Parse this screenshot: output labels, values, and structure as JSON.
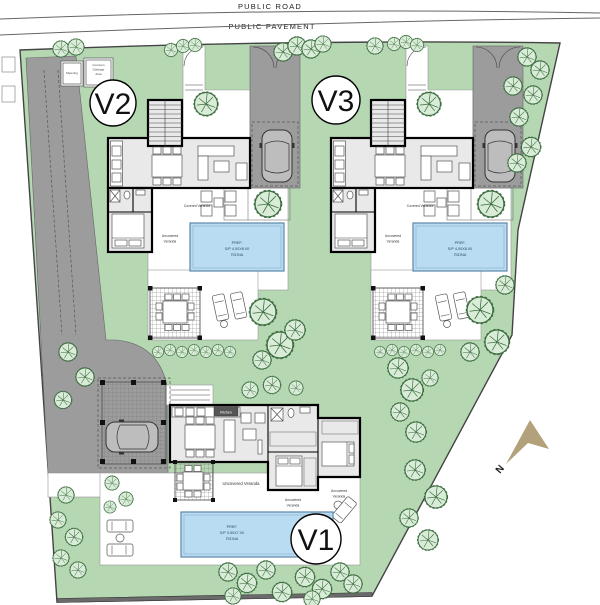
{
  "road": {
    "public_road": "PUBLIC ROAD",
    "public_pavement": "PUBLIC PAVEMENT"
  },
  "compass": {
    "label": "N",
    "color": "#b2a17b"
  },
  "villa_common": {
    "covered_veranda": "Covered Veranda",
    "uncovered_line1": "Uncovered",
    "uncovered_line2": "Veranda",
    "pool_line1": "PREF.",
    "pool_line2": "S/P 4.00X8.00",
    "pool_line3": "ΠΙΣΙΝΑ"
  },
  "villas": {
    "v1": {
      "label": "V1",
      "kitchen": "Kitchen",
      "pool_line1": "PREF.",
      "pool_line2": "S/P 3.50X7.00",
      "pool_line3": "ΠΙΣΙΝΑ",
      "uncovered_center": "Uncovered Veranda",
      "uncovered_1_line1": "Uncovered",
      "uncovered_1_line2": "Veranda",
      "uncovered_2_line1": "Uncovered",
      "uncovered_2_line2": "Veranda"
    },
    "v2": {
      "label": "V2"
    },
    "v3": {
      "label": "V3"
    }
  },
  "utilities": {
    "metering": "Metering",
    "garbage_1": "Common",
    "garbage_2": "Garbage",
    "garbage_3": "Area"
  },
  "colors": {
    "landscape_green": "#b5d7b2",
    "pool_blue": "#badcf2",
    "pool_border": "#5d87a8",
    "driveway_gray": "#9c9c9c",
    "building_gray": "#e9e9e9",
    "wall_black": "#000000",
    "tree_fill": "#d9ecd7",
    "tree_stroke": "#3a6b3e",
    "compass_tan": "#b2a17b"
  },
  "trees": [
    [
      61,
      49,
      0.8
    ],
    [
      76,
      47,
      0.8
    ],
    [
      171,
      50,
      0.65
    ],
    [
      183,
      46,
      0.65
    ],
    [
      195,
      45,
      0.65
    ],
    [
      283,
      52,
      0.9
    ],
    [
      297,
      46,
      0.9
    ],
    [
      311,
      49,
      0.9
    ],
    [
      323,
      44,
      0.8
    ],
    [
      375,
      46,
      0.8
    ],
    [
      394,
      44,
      0.65
    ],
    [
      406,
      42,
      0.65
    ],
    [
      417,
      45,
      0.65
    ],
    [
      527,
      57,
      0.9
    ],
    [
      540,
      70,
      0.9
    ],
    [
      513,
      86,
      0.9
    ],
    [
      533,
      95,
      0.9
    ],
    [
      519,
      117,
      0.9
    ],
    [
      531,
      147,
      0.95
    ],
    [
      517,
      163,
      0.9
    ],
    [
      68,
      352,
      0.9
    ],
    [
      85,
      377,
      0.9
    ],
    [
      63,
      400,
      0.85
    ],
    [
      158,
      352,
      0.55
    ],
    [
      170,
      350,
      0.55
    ],
    [
      182,
      352,
      0.55
    ],
    [
      194,
      350,
      0.55
    ],
    [
      206,
      352,
      0.55
    ],
    [
      218,
      350,
      0.55
    ],
    [
      230,
      352,
      0.55
    ],
    [
      263,
      312,
      1.3
    ],
    [
      280,
      345,
      1.3
    ],
    [
      262,
      360,
      0.9
    ],
    [
      295,
      330,
      1.0
    ],
    [
      380,
      352,
      0.55
    ],
    [
      392,
      350,
      0.55
    ],
    [
      404,
      352,
      0.55
    ],
    [
      416,
      350,
      0.55
    ],
    [
      428,
      352,
      0.55
    ],
    [
      440,
      350,
      0.55
    ],
    [
      480,
      310,
      1.3
    ],
    [
      497,
      342,
      1.2
    ],
    [
      470,
      352,
      0.9
    ],
    [
      505,
      285,
      0.9
    ],
    [
      398,
      368,
      1.0
    ],
    [
      412,
      390,
      1.1
    ],
    [
      400,
      412,
      0.9
    ],
    [
      416,
      432,
      1.0
    ],
    [
      430,
      378,
      0.8
    ],
    [
      250,
      390,
      0.8
    ],
    [
      272,
      385,
      0.85
    ],
    [
      296,
      388,
      0.7
    ],
    [
      112,
      483,
      0.7
    ],
    [
      126,
      499,
      0.7
    ],
    [
      110,
      507,
      0.6
    ],
    [
      66,
      495,
      0.8
    ],
    [
      58,
      520,
      0.8
    ],
    [
      74,
      537,
      0.85
    ],
    [
      61,
      558,
      0.8
    ],
    [
      78,
      570,
      0.8
    ],
    [
      415,
      470,
      1.0
    ],
    [
      436,
      497,
      1.1
    ],
    [
      409,
      518,
      0.9
    ],
    [
      428,
      540,
      1.0
    ],
    [
      228,
      572,
      0.9
    ],
    [
      247,
      583,
      0.95
    ],
    [
      266,
      570,
      0.9
    ],
    [
      282,
      592,
      0.95
    ],
    [
      233,
      596,
      0.8
    ],
    [
      305,
      577,
      0.95
    ],
    [
      322,
      589,
      0.95
    ],
    [
      340,
      572,
      0.9
    ],
    [
      353,
      584,
      0.9
    ],
    [
      312,
      599,
      0.8
    ]
  ]
}
